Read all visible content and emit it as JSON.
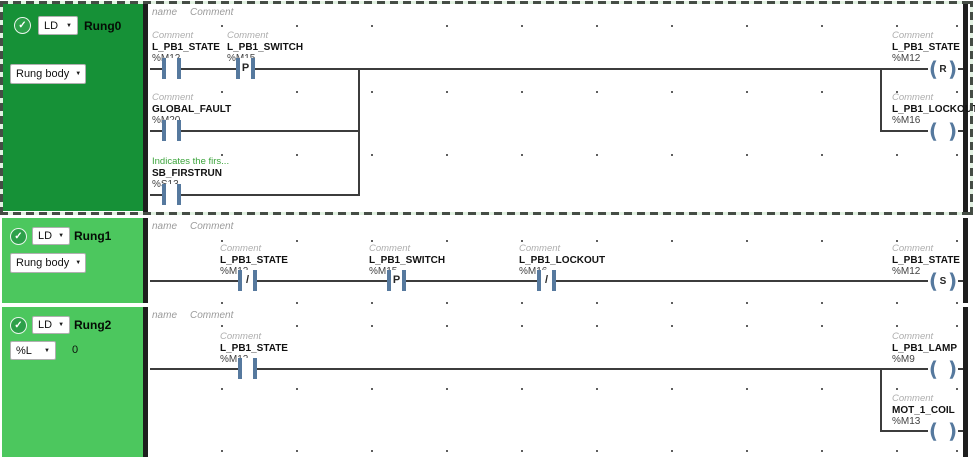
{
  "ui": {
    "check_icon": "✓",
    "dropdown_arrow": "▼",
    "coil_open": "(",
    "coil_close": ")",
    "header_name": "name",
    "header_comment": "Comment",
    "colors": {
      "rung0_panel_green": "#169137",
      "rung_panel_green": "#4cc75e",
      "symbol_blue": "#56799e",
      "custom_comment_green": "#3ba43b",
      "wire": "#3c3c3c"
    }
  },
  "rungs": [
    {
      "lang": "LD",
      "name": "Rung0",
      "body": "Rung body",
      "elements": {
        "c1": {
          "comment": "Comment",
          "name": "L_PB1_STATE",
          "addr": "%M12",
          "mid": ""
        },
        "c2": {
          "comment": "Comment",
          "name": "L_PB1_SWITCH",
          "addr": "%M15",
          "mid": "P"
        },
        "c3": {
          "comment": "Comment",
          "name": "GLOBAL_FAULT",
          "addr": "%M20",
          "mid": ""
        },
        "c4": {
          "comment": "Indicates the firs...",
          "name": "SB_FIRSTRUN",
          "addr": "%S13",
          "mid": ""
        },
        "coil1": {
          "comment": "Comment",
          "name": "L_PB1_STATE",
          "addr": "%M12",
          "letter": "R"
        },
        "coil2": {
          "comment": "Comment",
          "name": "L_PB1_LOCKOUT",
          "addr": "%M16",
          "letter": ""
        }
      }
    },
    {
      "lang": "LD",
      "name": "Rung1",
      "body": "Rung body",
      "elements": {
        "c1": {
          "comment": "Comment",
          "name": "L_PB1_STATE",
          "addr": "%M12",
          "mid": "/"
        },
        "c2": {
          "comment": "Comment",
          "name": "L_PB1_SWITCH",
          "addr": "%M15",
          "mid": "P"
        },
        "c3": {
          "comment": "Comment",
          "name": "L_PB1_LOCKOUT",
          "addr": "%M16",
          "mid": "/"
        },
        "coil1": {
          "comment": "Comment",
          "name": "L_PB1_STATE",
          "addr": "%M12",
          "letter": "S"
        }
      }
    },
    {
      "lang": "LD",
      "name": "Rung2",
      "body": "%L",
      "value": "0",
      "elements": {
        "c1": {
          "comment": "Comment",
          "name": "L_PB1_STATE",
          "addr": "%M12",
          "mid": ""
        },
        "coil1": {
          "comment": "Comment",
          "name": "L_PB1_LAMP",
          "addr": "%M9",
          "letter": ""
        },
        "coil2": {
          "comment": "Comment",
          "name": "MOT_1_COIL",
          "addr": "%M13",
          "letter": ""
        }
      }
    }
  ]
}
